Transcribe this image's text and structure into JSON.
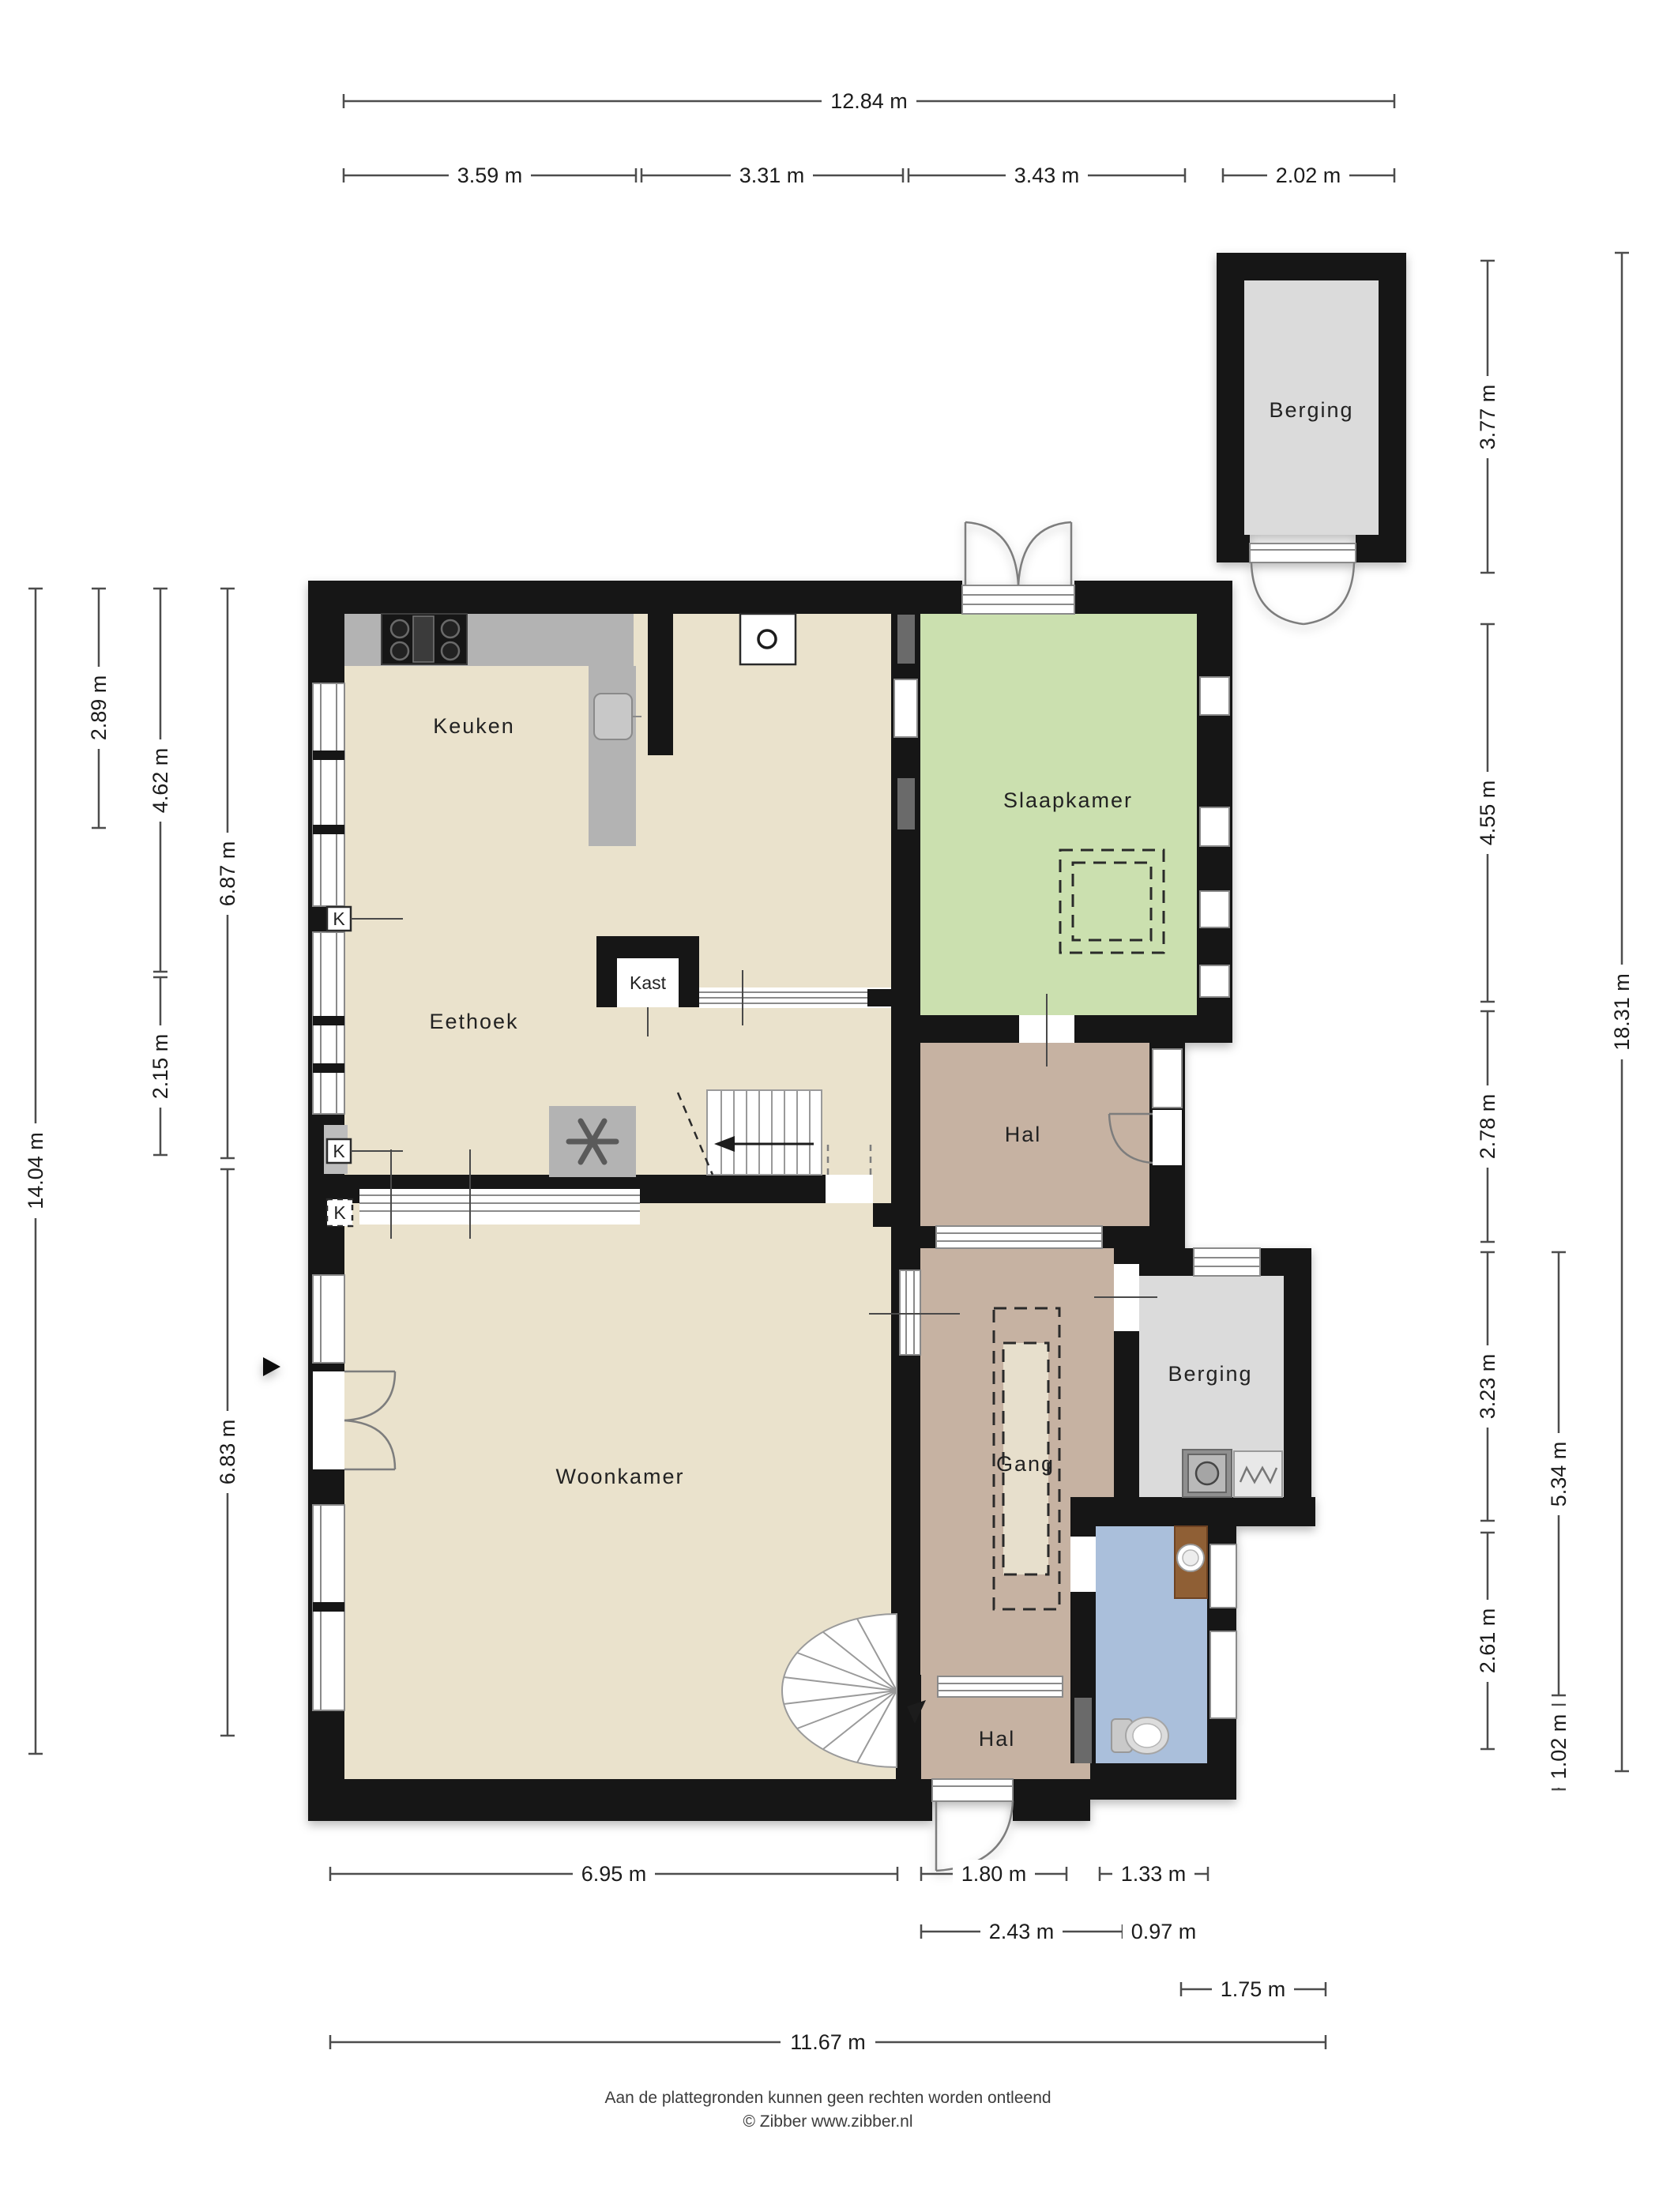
{
  "plan": {
    "type": "floorplan",
    "colors": {
      "wall": "#141414",
      "floor_living": "#EAE2CC",
      "floor_bedroom": "#CBE0AF",
      "floor_hall": "#C6B2A2",
      "floor_storage": "#DBDBDB",
      "floor_toilet": "#AABFDB",
      "kitchen_counter": "#B3B3B3",
      "wood_counter": "#8F5F35"
    },
    "rooms": {
      "keuken": "Keuken",
      "eethoek": "Eethoek",
      "woonkamer": "Woonkamer",
      "slaapkamer": "Slaapkamer",
      "hal_boven": "Hal",
      "gang": "Gang",
      "berging_rechts": "Berging",
      "hal_onder": "Hal",
      "berging_boven": "Berging",
      "kast": "Kast",
      "k_marker": "K"
    },
    "dimensions": {
      "top_total": "12.84 m",
      "top_segments": [
        "3.59 m",
        "3.31 m",
        "3.43 m",
        "2.02 m"
      ],
      "left_total": "14.04 m",
      "left_segments": [
        "2.89 m",
        "4.62 m",
        "2.15 m",
        "6.87 m",
        "6.83 m"
      ],
      "right_total": "18.31 m",
      "right_segments": [
        "3.77 m",
        "4.55 m",
        "2.78 m",
        "3.23 m",
        "2.61 m",
        "5.34 m",
        "1.02 m"
      ],
      "bottom_total": "11.67 m",
      "bottom_segments": [
        "6.95 m",
        "1.80 m",
        "1.33 m",
        "2.43 m",
        "0.97 m",
        "1.75 m"
      ]
    },
    "footer": {
      "disclaimer": "Aan de plattegronden kunnen geen rechten worden ontleend",
      "credit": "© Zibber www.zibber.nl"
    }
  }
}
